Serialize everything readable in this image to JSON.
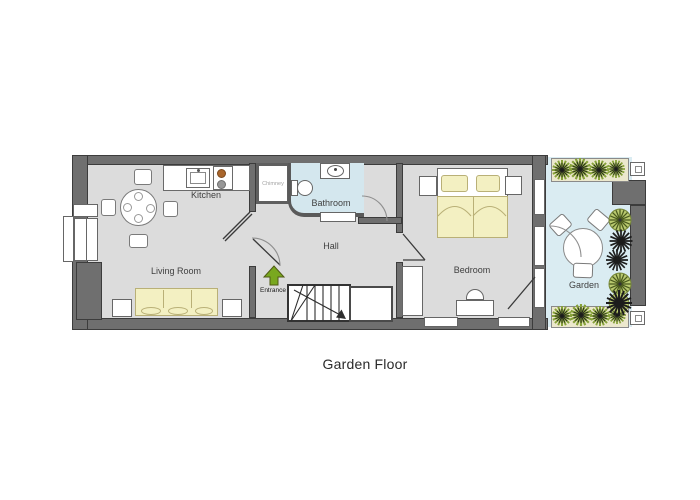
{
  "title": "Garden Floor",
  "rooms": {
    "kitchen": {
      "label": "Kitchen"
    },
    "living_room": {
      "label": "Living Room"
    },
    "chimney": {
      "label": "Chimney"
    },
    "bathroom": {
      "label": "Bathroom"
    },
    "hall": {
      "label": "Hall"
    },
    "entrance": {
      "label": "Entrance"
    },
    "bedroom": {
      "label": "Bedroom"
    },
    "garden": {
      "label": "Garden"
    }
  },
  "colors": {
    "wall": "#6f6f6f",
    "wall_edge": "#3c3c3c",
    "floor": "#dcdcdc",
    "bathroom_floor": "#d4e7ee",
    "garden_floor": "#daecf2",
    "furniture_fill": "#f3f0c2",
    "furniture_edge": "#b9b077",
    "entrance_arrow": "#79a81f",
    "plant_green": "#87a23a",
    "plant_green_light": "#b9c96f",
    "plant_dark": "#1c1c1c",
    "planter_bg": "#ece8cd",
    "stair_line": "#2e2e2e",
    "label_text": "#3f3f3f",
    "label_muted": "#a3a3a3",
    "title_text": "#2a2a2a"
  }
}
